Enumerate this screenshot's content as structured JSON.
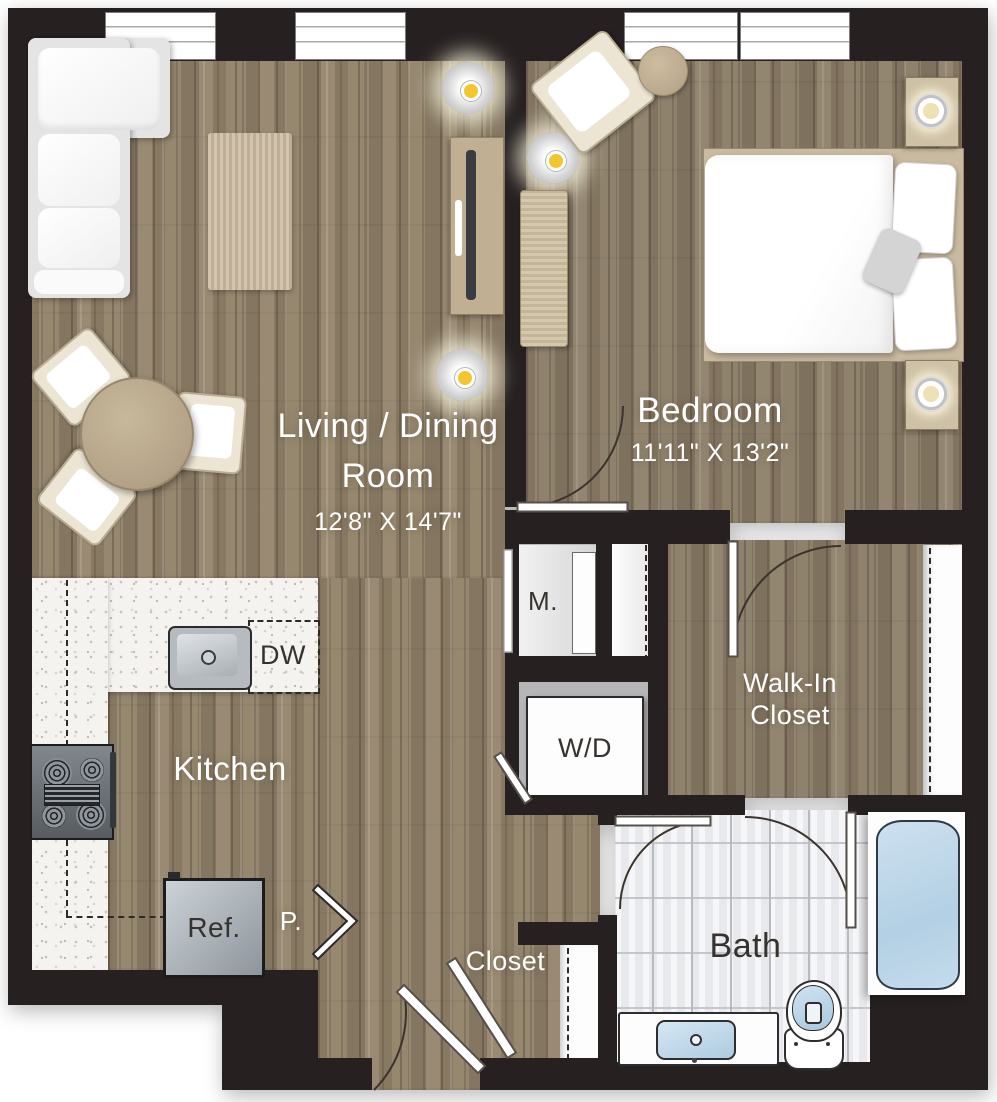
{
  "plan": {
    "rooms": {
      "living": {
        "line1": "Living / Dining",
        "line2": "Room",
        "dims": "12'8\" X 14'7\""
      },
      "bedroom": {
        "name": "Bedroom",
        "dims": "11'11\" X 13'2\""
      },
      "kitchen": {
        "name": "Kitchen"
      },
      "walk_in": {
        "line1": "Walk-In",
        "line2": "Closet"
      },
      "bath": {
        "name": "Bath"
      },
      "closet": {
        "name": "Closet"
      }
    },
    "fixtures": {
      "dishwasher": "DW",
      "mechanical": "M.",
      "washer_dryer": "W/D",
      "refrigerator": "Ref.",
      "pantry": "P."
    },
    "colors": {
      "wall": "#262120",
      "wood_floor": "#95866f",
      "counter": "#f5f3ef",
      "tile": "#eceef0",
      "fixture_blue": "#bcd7ea",
      "light_accent": "#f4c62e",
      "label_light": "#ffffff",
      "label_dark": "#36322e"
    }
  }
}
